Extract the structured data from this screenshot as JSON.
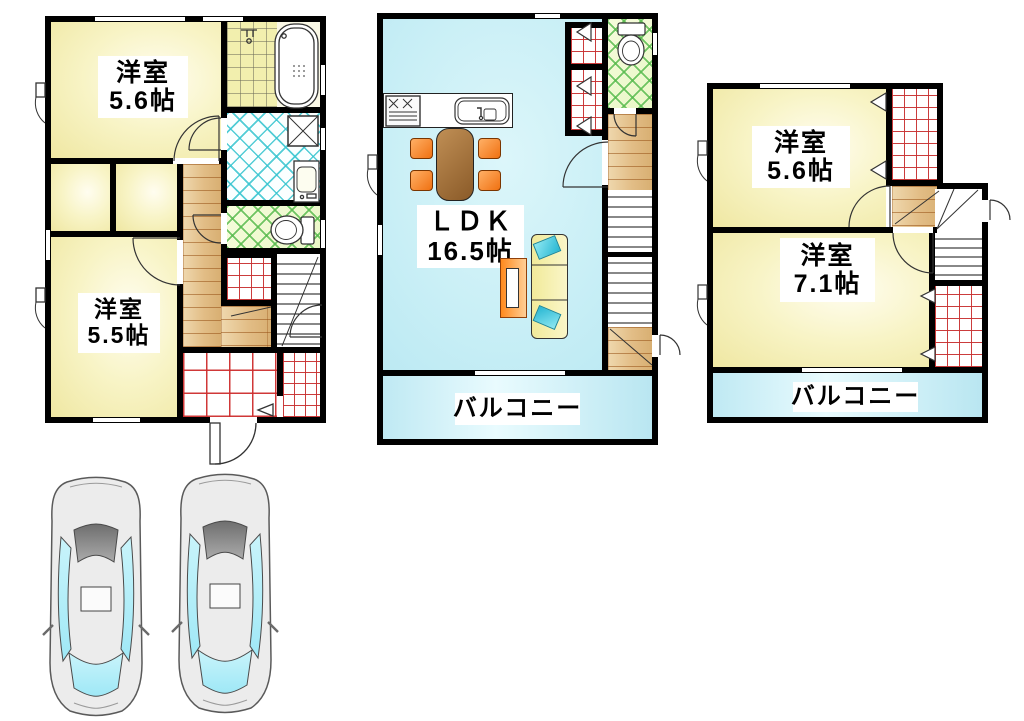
{
  "palette": {
    "wall": "#000000",
    "room_yellow": "#f6f2b8",
    "ldk_cyan": "#c7eef6",
    "balcony_cyan": "#cdeff7",
    "wood_floor": "#e4c28c",
    "closet_grid_red": "#c83232",
    "washroom_hatch_cyan": "#35c4cf",
    "toilet_hatch_green": "#58bb4e",
    "chair_orange": "#f07112",
    "table_brown": "#8a5a28",
    "sofa_yellow": "#f1ea9a",
    "pillow_cyan": "#27b6d2",
    "tv_orange": "#ff8a1e",
    "car_window_cyan": "#b6eff9"
  },
  "floors": {
    "f1": {
      "room_a_name": "洋室",
      "room_a_size": "5.6帖",
      "room_b_name": "洋室",
      "room_b_size": "5.5帖"
    },
    "f2": {
      "ldk_name": "ＬＤＫ",
      "ldk_size": "16.5帖",
      "balcony": "バルコニー"
    },
    "f3": {
      "room_a_name": "洋室",
      "room_a_size": "5.6帖",
      "room_b_name": "洋室",
      "room_b_size": "7.1帖",
      "balcony": "バルコニー"
    }
  }
}
